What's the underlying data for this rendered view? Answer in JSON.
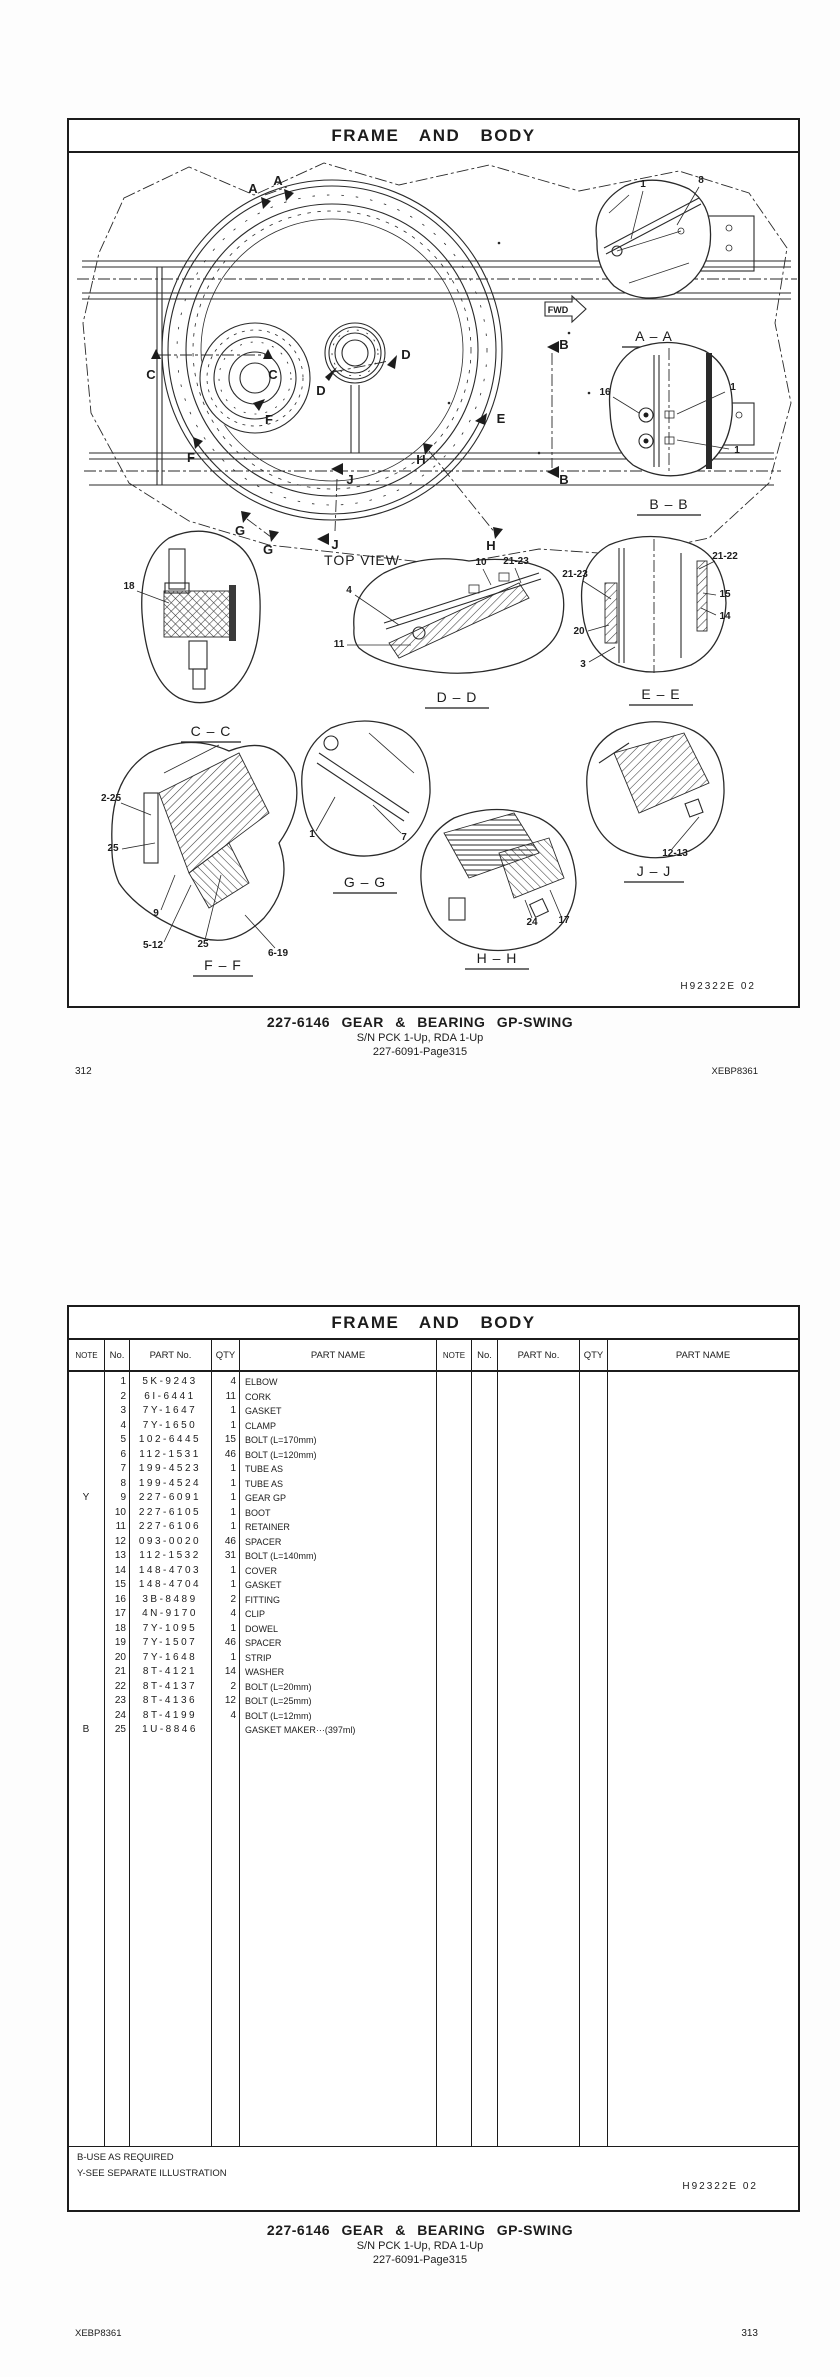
{
  "page1": {
    "header_title": "FRAME  AND  BODY",
    "doc_code": "H92322E   02",
    "caption": {
      "title": "227-6146   GEAR  &  BEARING  GP-SWING",
      "serial": "S/N PCK 1-Up, RDA 1-Up",
      "page_ref": "227-6091-Page315"
    },
    "page_number": "312",
    "book_code": "XEBP8361",
    "diagram": {
      "top_view_label": "TOP  VIEW",
      "fwd_label": "FWD",
      "marks": {
        "a1": "A",
        "a2": "A",
        "b1": "B",
        "b2": "B",
        "c1": "C",
        "c2": "C",
        "d1": "D",
        "d2": "D",
        "e1": "E",
        "f1": "F",
        "f2": "F",
        "g1": "G",
        "g2": "G",
        "h1": "H",
        "h2": "H",
        "j1": "J",
        "j2": "J"
      },
      "views": {
        "aa": {
          "title": "A – A",
          "callouts": [
            "1",
            "8"
          ]
        },
        "bb": {
          "title": "B – B",
          "callouts": [
            "16",
            "1",
            "1"
          ]
        },
        "cc": {
          "title": "C – C",
          "callouts": [
            "18"
          ]
        },
        "dd": {
          "title": "D – D",
          "callouts": [
            "4",
            "10",
            "21-23",
            "11"
          ]
        },
        "ee": {
          "title": "E – E",
          "callouts": [
            "21-23",
            "21-22",
            "15",
            "14",
            "20",
            "3"
          ]
        },
        "ff": {
          "title": "F – F",
          "callouts": [
            "2-25",
            "25",
            "9",
            "5-12",
            "25",
            "6-19"
          ]
        },
        "gg": {
          "title": "G – G",
          "callouts": [
            "1",
            "7"
          ]
        },
        "hh": {
          "title": "H – H",
          "callouts": [
            "24",
            "17"
          ]
        },
        "jj": {
          "title": "J – J",
          "callouts": [
            "12-13"
          ]
        }
      }
    }
  },
  "page2": {
    "header_title": "FRAME  AND  BODY",
    "table": {
      "headers": [
        "NOTE",
        "No.",
        "PART No.",
        "QTY",
        "PART NAME"
      ],
      "rows": [
        {
          "note": "",
          "no": "1",
          "part": "5K-9243",
          "qty": "4",
          "name": "ELBOW"
        },
        {
          "note": "",
          "no": "2",
          "part": "6I-6441",
          "qty": "11",
          "name": "CORK"
        },
        {
          "note": "",
          "no": "3",
          "part": "7Y-1647",
          "qty": "1",
          "name": "GASKET"
        },
        {
          "note": "",
          "no": "4",
          "part": "7Y-1650",
          "qty": "1",
          "name": "CLAMP"
        },
        {
          "note": "",
          "no": "5",
          "part": "102-6445",
          "qty": "15",
          "name": "BOLT (L=170mm)"
        },
        {
          "note": "",
          "no": "6",
          "part": "112-1531",
          "qty": "46",
          "name": "BOLT (L=120mm)"
        },
        {
          "note": "",
          "no": "7",
          "part": "199-4523",
          "qty": "1",
          "name": "TUBE AS"
        },
        {
          "note": "",
          "no": "8",
          "part": "199-4524",
          "qty": "1",
          "name": "TUBE AS"
        },
        {
          "note": "Y",
          "no": "9",
          "part": "227-6091",
          "qty": "1",
          "name": "GEAR GP"
        },
        {
          "note": "",
          "no": "10",
          "part": "227-6105",
          "qty": "1",
          "name": "BOOT"
        },
        {
          "note": "",
          "no": "11",
          "part": "227-6106",
          "qty": "1",
          "name": "RETAINER"
        },
        {
          "note": "",
          "no": "12",
          "part": "093-0020",
          "qty": "46",
          "name": "SPACER"
        },
        {
          "note": "",
          "no": "13",
          "part": "112-1532",
          "qty": "31",
          "name": "BOLT (L=140mm)"
        },
        {
          "note": "",
          "no": "14",
          "part": "148-4703",
          "qty": "1",
          "name": "COVER"
        },
        {
          "note": "",
          "no": "15",
          "part": "148-4704",
          "qty": "1",
          "name": "GASKET"
        },
        {
          "note": "",
          "no": "16",
          "part": "3B-8489",
          "qty": "2",
          "name": "FITTING"
        },
        {
          "note": "",
          "no": "17",
          "part": "4N-9170",
          "qty": "4",
          "name": "CLIP"
        },
        {
          "note": "",
          "no": "18",
          "part": "7Y-1095",
          "qty": "1",
          "name": "DOWEL"
        },
        {
          "note": "",
          "no": "19",
          "part": "7Y-1507",
          "qty": "46",
          "name": "SPACER"
        },
        {
          "note": "",
          "no": "20",
          "part": "7Y-1648",
          "qty": "1",
          "name": "STRIP"
        },
        {
          "note": "",
          "no": "21",
          "part": "8T-4121",
          "qty": "14",
          "name": "WASHER"
        },
        {
          "note": "",
          "no": "22",
          "part": "8T-4137",
          "qty": "2",
          "name": "BOLT (L=20mm)"
        },
        {
          "note": "",
          "no": "23",
          "part": "8T-4136",
          "qty": "12",
          "name": "BOLT (L=25mm)"
        },
        {
          "note": "",
          "no": "24",
          "part": "8T-4199",
          "qty": "4",
          "name": "BOLT (L=12mm)"
        },
        {
          "note": "B",
          "no": "25",
          "part": "1U-8846",
          "qty": "",
          "name": "GASKET MAKER···(397ml)"
        }
      ]
    },
    "footnotes": [
      "B-USE AS REQUIRED",
      "Y-SEE SEPARATE ILLUSTRATION"
    ],
    "doc_code": "H92322E   02",
    "caption": {
      "title": "227-6146   GEAR  &  BEARING  GP-SWING",
      "serial": "S/N PCK 1-Up, RDA 1-Up",
      "page_ref": "227-6091-Page315"
    },
    "page_number": "313",
    "book_code": "XEBP8361"
  }
}
